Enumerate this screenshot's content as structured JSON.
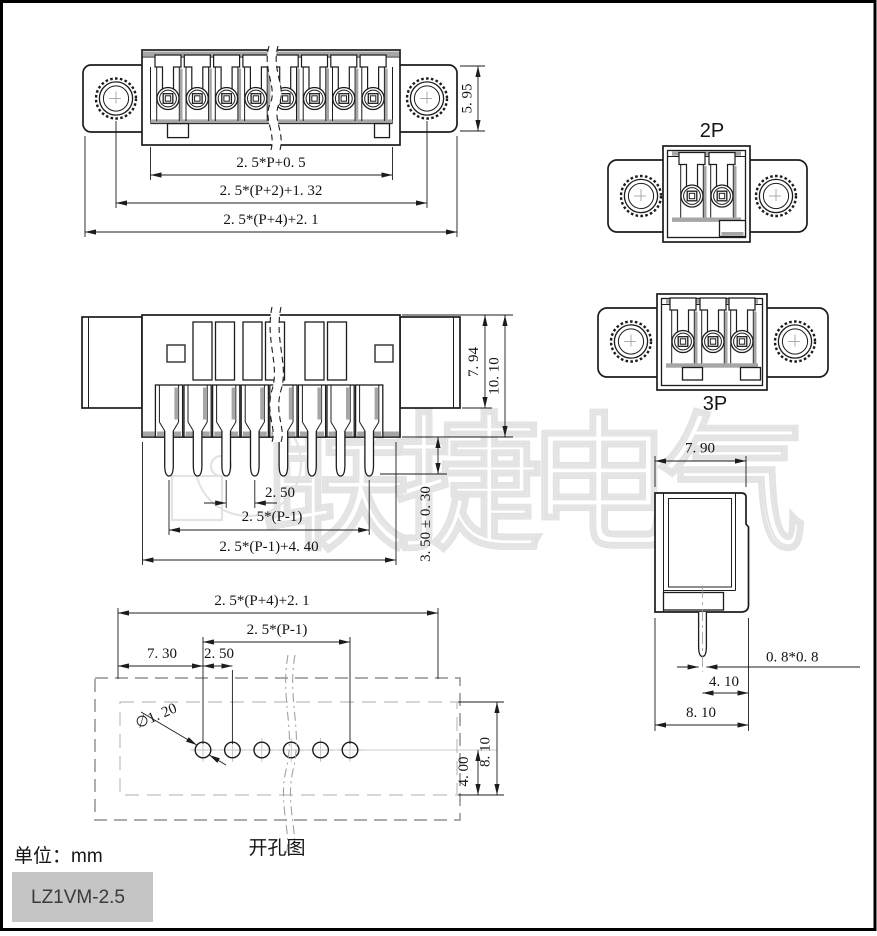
{
  "colors": {
    "line": "#1c1c1c",
    "shade": "#a6a6a6",
    "watermark": "#e3e3e3",
    "model_box_bg": "#c5c5c5",
    "frame": "#000000"
  },
  "watermark": {
    "text": "联捷电气"
  },
  "views": {
    "front": {
      "dims": {
        "height": "5. 95",
        "pin_span": "2. 5*P+0. 5",
        "mount_span": "2. 5*(P+2)+1. 32",
        "overall": "2. 5*(P+4)+2. 1"
      }
    },
    "two_pin": {
      "label": "2P"
    },
    "three_pin": {
      "label": "3P"
    },
    "bottom": {
      "dims": {
        "body_height": "7. 94",
        "overall_height": "10. 10",
        "pitch": "2. 50",
        "pin_span": "2. 5*(P-1)",
        "base_width": "2. 5*(P-1)+4. 40",
        "pin_length": "3. 50 ± 0. 30"
      }
    },
    "side": {
      "dims": {
        "top_width": "7. 90",
        "pin_section": "0. 8*0. 8",
        "pin_to_edge": "4. 10",
        "overall_width": "8. 10"
      }
    },
    "drill": {
      "caption": "开孔图",
      "dims": {
        "overall": "2. 5*(P+4)+2. 1",
        "hole_span": "2. 5*(P-1)",
        "edge_offset": "7. 30",
        "pitch": "2. 50",
        "hole_dia": "∅1. 20",
        "height": "8. 10",
        "row_offset": "4. 00"
      }
    }
  },
  "footer": {
    "unit": "单位：mm",
    "model": "LZ1VM-2.5"
  }
}
